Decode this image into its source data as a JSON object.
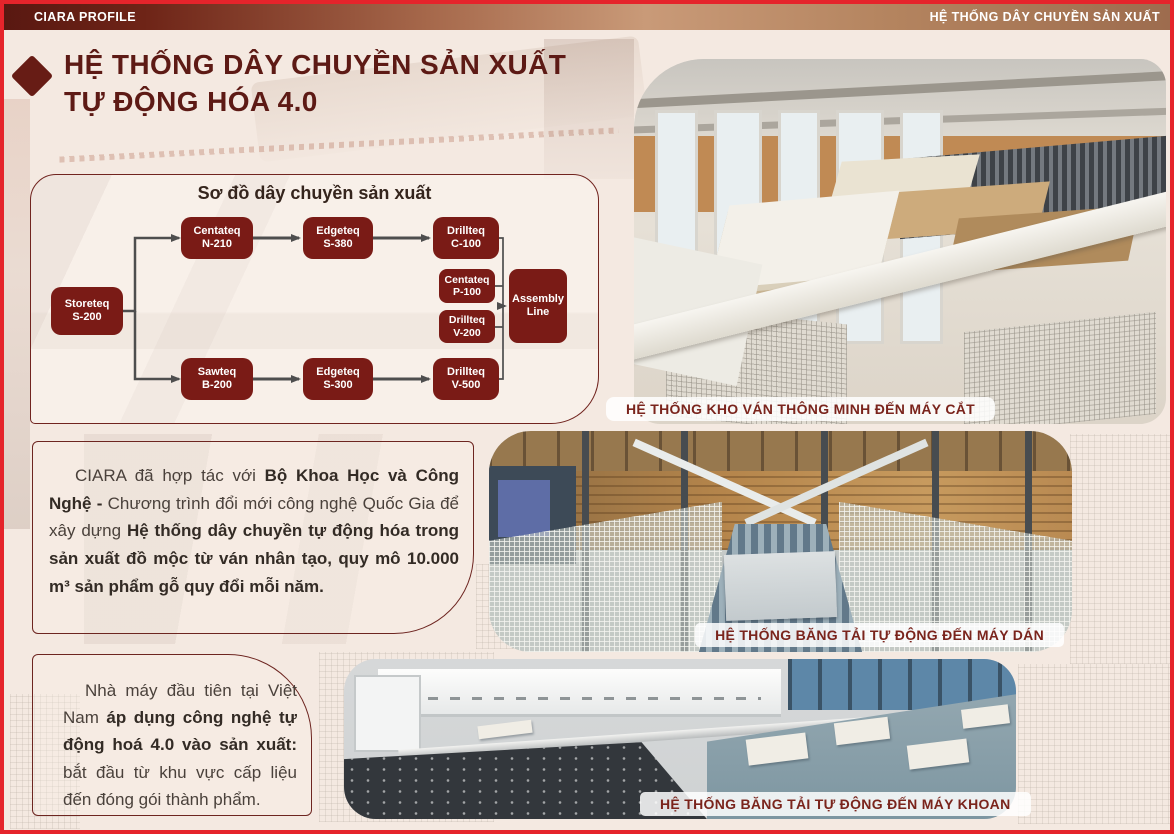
{
  "top_bar": {
    "left_label": "CIARA PROFILE",
    "right_label": "HỆ THỐNG DÂY CHUYỀN SẢN XUẤT"
  },
  "title": {
    "line1": "HỆ THỐNG DÂY CHUYỀN SẢN XUẤT",
    "line2": "TỰ ĐỘNG HÓA 4.0"
  },
  "flowchart": {
    "title": "Sơ đồ dây chuyền sản xuất",
    "nodes": {
      "storeteq": {
        "line1": "Storeteq",
        "line2": "S-200"
      },
      "centateq_n210": {
        "line1": "Centateq",
        "line2": "N-210"
      },
      "edgeteq_s380": {
        "line1": "Edgeteq",
        "line2": "S-380"
      },
      "drillteq_c100": {
        "line1": "Drillteq",
        "line2": "C-100"
      },
      "centateq_p100": {
        "line1": "Centateq",
        "line2": "P-100"
      },
      "drillteq_v200": {
        "line1": "Drillteq",
        "line2": "V-200"
      },
      "sawteq_b200": {
        "line1": "Sawteq",
        "line2": "B-200"
      },
      "edgeteq_s300": {
        "line1": "Edgeteq",
        "line2": "S-300"
      },
      "drillteq_v500": {
        "line1": "Drillteq",
        "line2": "V-500"
      },
      "assembly": {
        "line1": "Assembly",
        "line2": "Line"
      }
    }
  },
  "paragraph1": {
    "seg1": "CIARA đã hợp tác với ",
    "seg2": "Bộ Khoa Học và Công Nghệ - ",
    "seg3": "Chương trình đổi mới công nghệ Quốc Gia để xây dựng ",
    "seg4": "Hệ thống dây chuyền tự động hóa trong sản xuất đồ mộc từ ván nhân tạo, quy mô 10.000 m³ sản phẩm gỗ quy đổi mỗi năm."
  },
  "paragraph2": {
    "seg1": "Nhà máy đầu tiên tại Việt Nam ",
    "seg2": "áp dụng công nghệ tự động hoá 4.0 vào sản xuất:",
    "seg3": " bắt đầu từ khu vực cấp liệu đến đóng gói thành phẩm."
  },
  "photos": {
    "photo1_caption": "HỆ THỐNG KHO VÁN THÔNG MINH ĐẾN MÁY CẮT",
    "photo2_caption": "HỆ THỐNG BĂNG TẢI TỰ ĐỘNG ĐẾN MÁY DÁN",
    "photo3_caption": "HỆ THỐNG BĂNG TẢI TỰ ĐỘNG ĐẾN MÁY KHOAN"
  },
  "colors": {
    "maroon_node": "#7a1b16",
    "maroon_text": "#5d1a15",
    "page_border_red": "#e5242b",
    "background": "#f4e9e1",
    "arrow_gray": "#4e4e4e"
  }
}
